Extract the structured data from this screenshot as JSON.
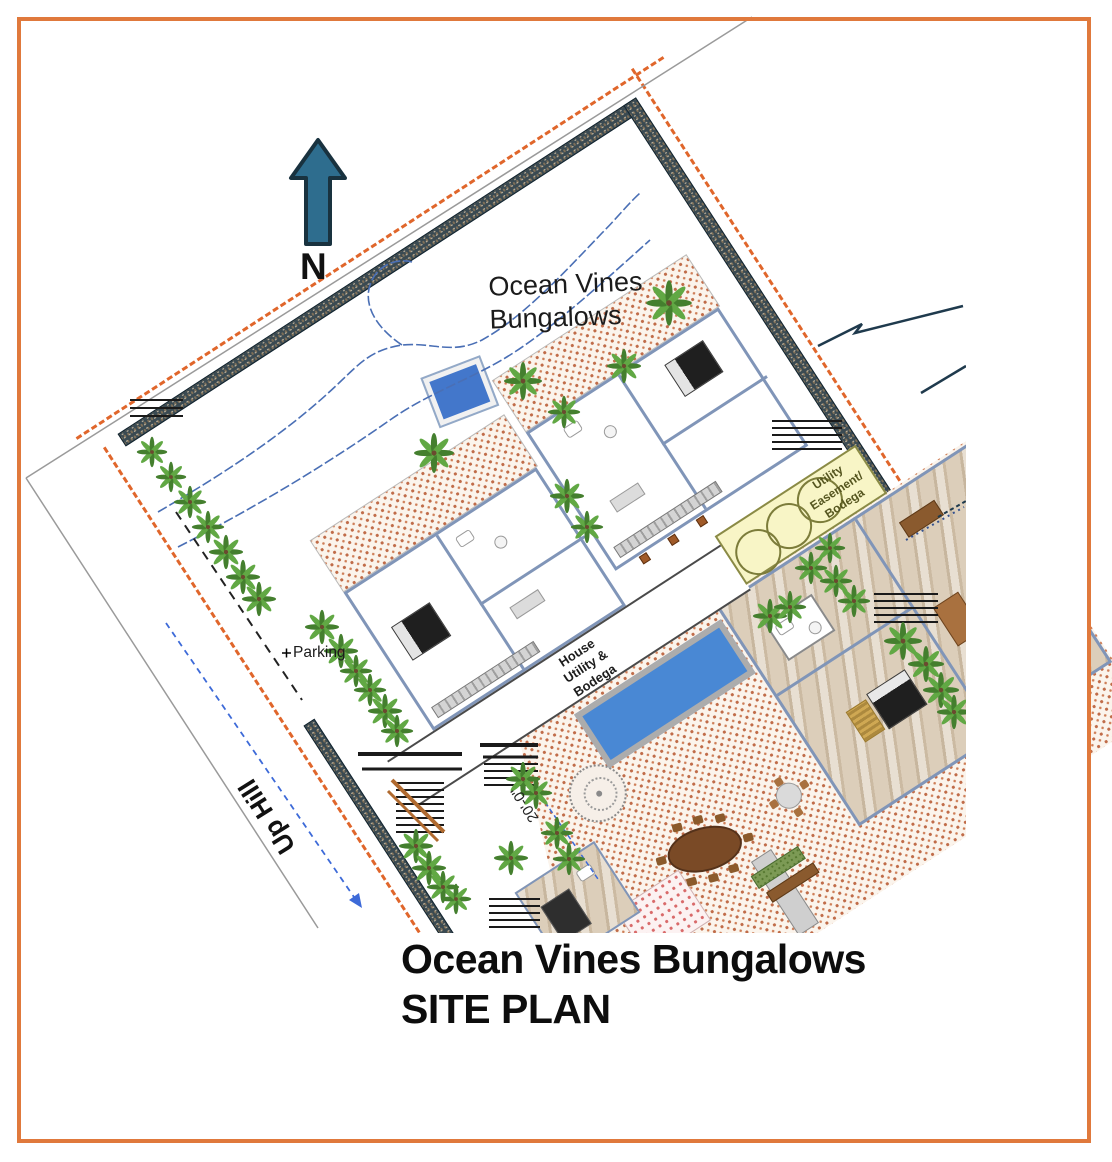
{
  "north_indicator": {
    "label": "N",
    "arrow_color": "#2E6D8E"
  },
  "plan_labels": {
    "site_name_line1": "Ocean Vines",
    "site_name_line2": "Bungalows",
    "parking": "Parking",
    "up_hill": "Up Hill",
    "dimension": "20'-0\"",
    "utility_easement": "Utility Easement/ Bodega",
    "house_utility": "House Utility & Bodega"
  },
  "title_block": {
    "line1": "Ocean Vines Bungalows",
    "line2": "SITE PLAN"
  },
  "colors": {
    "frame": "#E0793C",
    "property_line": "#E0662B",
    "wall": "#3A4A52",
    "pool": "#4988D4",
    "easement_fill": "#F8F5C6",
    "tile_dot": "#C06C49",
    "contour": "#4A6FB5",
    "uphill_arrow": "#3D6AD8",
    "tree_green": "#4E8F35"
  }
}
